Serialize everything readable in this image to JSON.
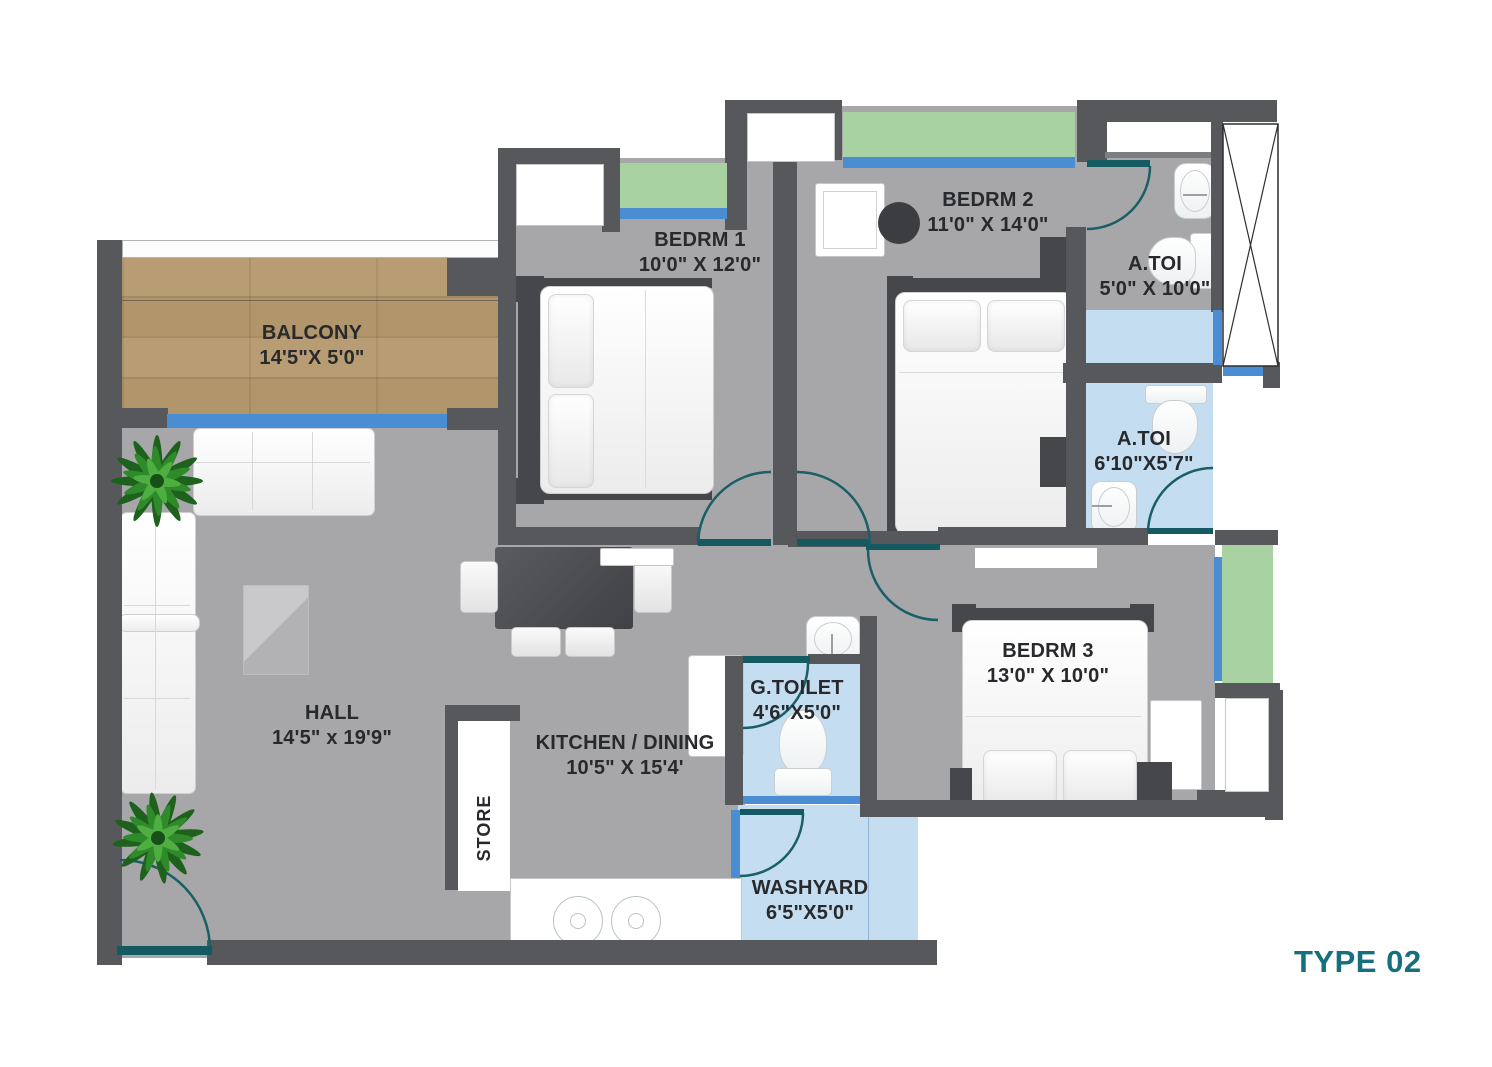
{
  "title": "TYPE 02",
  "plan_colors": {
    "wall": "#57585b",
    "floor": "#a7a7a9",
    "wet_floor": "#c5ddf0",
    "window_glass": "#4a8dd2",
    "planter_green": "#a8d2a2",
    "balcony_wood": "#b2966b",
    "door_arc_teal": "#1a5f66",
    "accent_teal": "#156f7d",
    "label_text": "#27292c"
  },
  "rooms": [
    {
      "id": "balcony",
      "label": "BALCONY",
      "dims": "14'5\"X 5'0\""
    },
    {
      "id": "bedrm1",
      "label": "BEDRM 1",
      "dims": "10'0\" X 12'0\""
    },
    {
      "id": "bedrm2",
      "label": "BEDRM 2",
      "dims": "11'0\" X 14'0\""
    },
    {
      "id": "atoi-1",
      "label": "A.TOI",
      "dims": "5'0\" X 10'0\""
    },
    {
      "id": "atoi-2",
      "label": "A.TOI",
      "dims": "6'10\"X5'7\""
    },
    {
      "id": "bedrm3",
      "label": "BEDRM 3",
      "dims": "13'0\" X 10'0\""
    },
    {
      "id": "gtoilet",
      "label": "G.TOILET",
      "dims": "4'6\"X5'0\""
    },
    {
      "id": "hall",
      "label": "HALL",
      "dims": "14'5\" x 19'9\""
    },
    {
      "id": "kitchen",
      "label": "KITCHEN / DINING",
      "dims": "10'5\" X 15'4'"
    },
    {
      "id": "store",
      "label": "STORE",
      "dims": ""
    },
    {
      "id": "washyard",
      "label": "WASHYARD",
      "dims": "6'5\"X5'0\""
    }
  ]
}
